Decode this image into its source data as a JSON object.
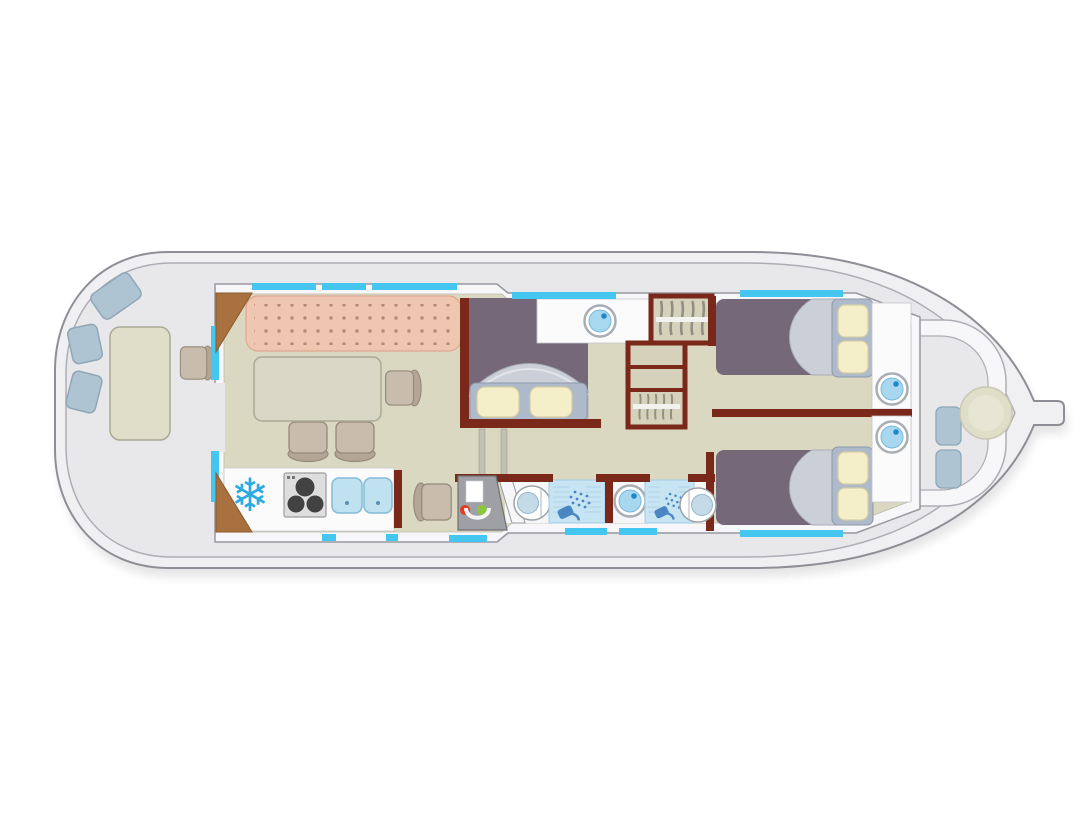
{
  "plan": {
    "subject": "canal houseboat deck plan, top-down view, bow to the right",
    "visible_text": []
  },
  "colors": {
    "bg": "#ffffff",
    "shadow": "#000000",
    "hull_fill": "#F0F0F3",
    "hull_stroke": "#8E8E96",
    "deck": "#E8E8EB",
    "deck_stroke": "#ADADB5",
    "wall_fill": "#F7F7F9",
    "wall_stroke": "#97979F",
    "window": "#45C6F0",
    "floor": "#DBD8C2",
    "floor_stroke": "#BDBBAA",
    "wall_red": "#7A281A",
    "door_wood": "#A9713F",
    "door_wood_stroke": "#8A5A2B",
    "bench": "#EFC7B0",
    "bench_dot": "#B5887A",
    "bench_stroke": "#DDA88F",
    "table": "#D9D8C6",
    "table_stroke": "#A9A996",
    "chair": "#C8BCAD",
    "chair_dark": "#B3A695",
    "chair_stroke": "#95897B",
    "cushion": "#AEC4D2",
    "cushion_stroke": "#8FA7B6",
    "mattress": "#756878",
    "duvet": "#CBCFD7",
    "duvet_stroke": "#A8AEB8",
    "duvet_light": "#E2E5EA",
    "pillow": "#F5EFC9",
    "pillow_stroke": "#D6CEA2",
    "bed_frame": "#AEB9C9",
    "bed_frame_stroke": "#8D99AB",
    "counter": "#FBFBFC",
    "counter_stroke": "#C6C6CC",
    "basin": "#A8D8EF",
    "basin_stroke": "#79B7D8",
    "basin_ring": "#A9AEB5",
    "basin_dot": "#2187C8",
    "shower_panel": "#C7E4F3",
    "shower_panel_stroke": "#A2CBE2",
    "shower_line": "#AFD3E8",
    "shower_icon": "#4A86C2",
    "wardrobe_fill": "#D5D1BB",
    "hanger": "#8F8F82",
    "rail": "#F2F2F0",
    "stove": "#DEDEDE",
    "stove_stroke": "#9C9CA0",
    "burner": "#424242",
    "sink": "#BFE1F0",
    "sink_stroke": "#85BBD6",
    "sink_dot": "#5A93B5",
    "fridge_icon": "#2FAAE0",
    "console": "#9EA0A6",
    "console_stroke": "#6F7076",
    "console_red": "#E23A25",
    "console_green": "#8CC63F",
    "bow_table": "#DFDEC9",
    "bow_table_stroke": "#C9C8B2",
    "bow_table_inner": "#E7E6D4",
    "bath_floor": "#F4F6F8",
    "toilet_seat": "#C4DAE7",
    "toilet_seat_stroke": "#8FB7CC",
    "toilet_stroke": "#9EA3AA",
    "step": "#C0C0B5",
    "step_stroke": "#9A9A90",
    "screen": "#FFFFFF",
    "wheel": "#F4F4F4",
    "knob": "#777777"
  },
  "icons": {
    "fridge": "snowflake",
    "shower": "shower-head-with-spray",
    "wardrobe": "clothes-hangers-on-rail",
    "washbasin": "round-basin-with-drain-dot",
    "stove": "three-burner-hob",
    "windows": "cyan-glazing-strips"
  },
  "rooms": [
    {
      "id": "aft-deck",
      "label": "aft deck",
      "items": [
        "deck cushion",
        "deck cushion",
        "deck cushion",
        "deck table",
        "deck chair"
      ]
    },
    {
      "id": "saloon",
      "label": "saloon",
      "items": [
        "upholstered sofa bench",
        "dining table",
        "chair",
        "chair",
        "chair"
      ]
    },
    {
      "id": "galley",
      "label": "galley",
      "items": [
        "fridge (snowflake)",
        "three-burner stove",
        "double sink"
      ]
    },
    {
      "id": "helm-station",
      "label": "inner steering position",
      "items": [
        "helm seat",
        "console with wheel, screen and red/green indicators"
      ]
    },
    {
      "id": "mid-cabin",
      "label": "midship double cabin",
      "items": [
        "double bed with two pillows",
        "washbasin counter"
      ]
    },
    {
      "id": "corridor",
      "label": "corridor with steps",
      "items": [
        "companionway steps",
        "hanging wardrobe",
        "shelf unit",
        "lower hanging locker"
      ]
    },
    {
      "id": "shower-room-aft",
      "label": "shower room (aft)",
      "items": [
        "toilet",
        "shower cubicle"
      ]
    },
    {
      "id": "shower-room-fwd",
      "label": "shower room (forward)",
      "items": [
        "washbasin",
        "shower cubicle",
        "toilet"
      ]
    },
    {
      "id": "bow-cabin-top",
      "label": "forward double cabin (upper)",
      "items": [
        "double bed with two pillows",
        "washbasin counter"
      ]
    },
    {
      "id": "bow-cabin-bottom",
      "label": "forward double cabin (lower)",
      "items": [
        "double bed with two pillows",
        "washbasin counter"
      ]
    },
    {
      "id": "bow-deck",
      "label": "bow deck",
      "items": [
        "curved bench",
        "deck cushion",
        "deck cushion",
        "round table"
      ]
    }
  ]
}
